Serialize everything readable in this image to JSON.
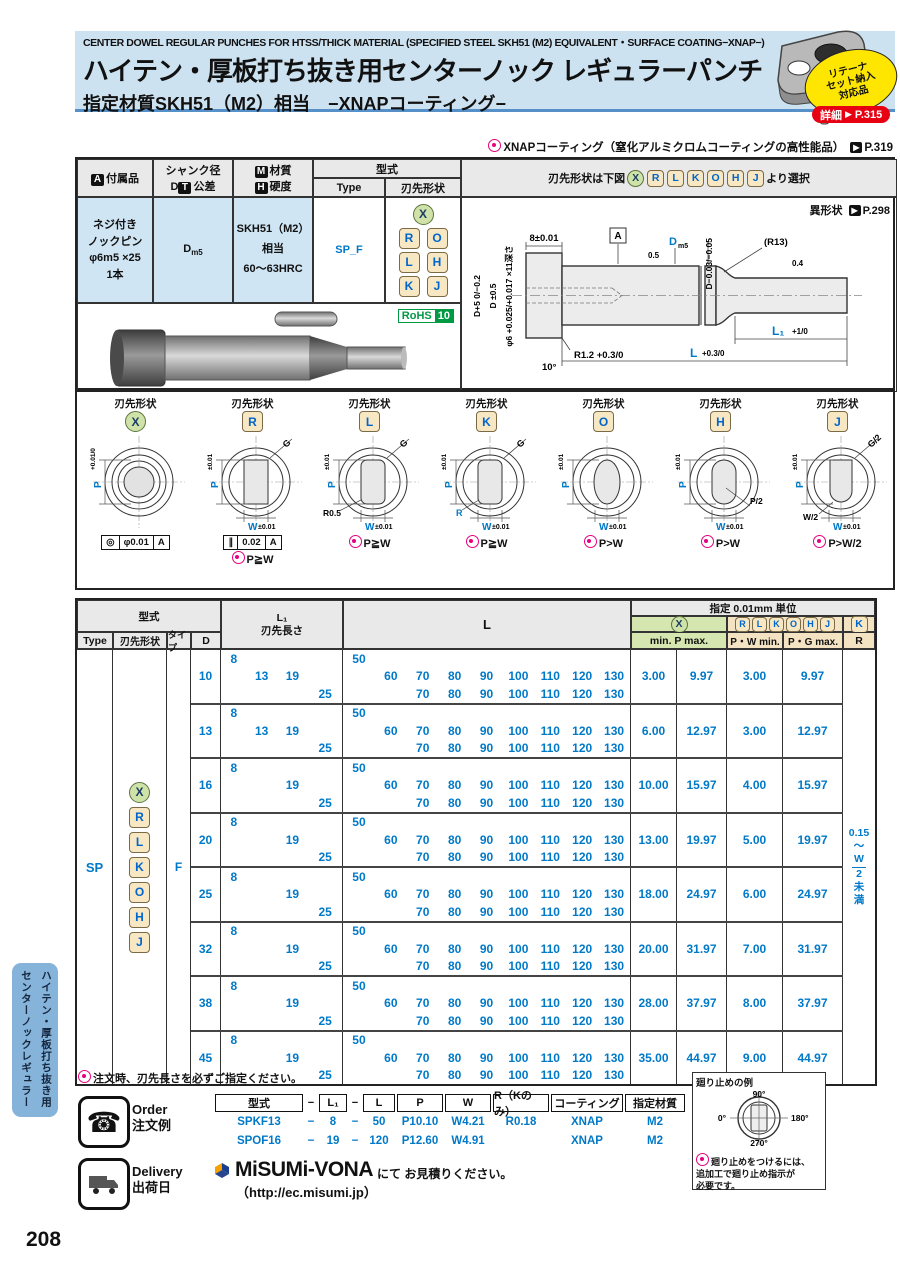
{
  "page": {
    "number": "208"
  },
  "sidebar": {
    "line1": "ハイテン・厚板打ち抜き用",
    "line2": "センターノックレギュラー"
  },
  "header": {
    "title_en": "CENTER DOWEL REGULAR PUNCHES FOR HTSS/THICK MATERIAL (SPECIFIED STEEL SKH51 (M2) EQUIVALENT・SURFACE COATING−XNAP−)",
    "title_jp": "ハイテン・厚板打ち抜き用センターノック レギュラーパンチ",
    "subtitle_jp": "指定材質SKH51（M2）相当　−XNAPコーティング−"
  },
  "retainer": {
    "badge_lines": [
      "リテーナ",
      "セット納入",
      "対応品"
    ],
    "detail_label": "詳細",
    "detail_page": "P.315"
  },
  "xnap_note": {
    "text": "XNAPコーティング（窒化アルミクロムコーティングの高性能品）",
    "page": "P.319"
  },
  "spec_table": {
    "accessory_badge": "A",
    "accessory_hdr": "付属品",
    "shank_hdr1": "シャンク径",
    "shank_d": "D",
    "shank_t": "T",
    "shank_hdr2": "公差",
    "material_m": "M",
    "material_hdr": "材質",
    "hardness_h": "H",
    "hardness_hdr": "硬度",
    "model_hdr": "型式",
    "type_hdr": "Type",
    "tip_hdr": "刃先形状",
    "select_pre": "刃先形状は下図",
    "select_letters": [
      "X",
      "R",
      "L",
      "K",
      "O",
      "H",
      "J"
    ],
    "select_post": "より選択",
    "accessory_lines": [
      "ネジ付き",
      "ノックピン",
      "φ6m5 ×25",
      "1本"
    ],
    "shank_value_main": "D",
    "shank_value_sub": "m5",
    "material_value1": "SKH51（M2）相当",
    "material_value2": "60〜63HRC",
    "type_value": "SP_F",
    "tip_rows": [
      [
        "R",
        "O"
      ],
      [
        "L",
        "H"
      ],
      [
        "K",
        "J"
      ]
    ],
    "rohs_label": "RoHS",
    "rohs_num": "10",
    "alt_shape_note": "異形状",
    "alt_shape_page": "P.298"
  },
  "drawing": {
    "dim8": "8±0.01",
    "datum": "A",
    "sf1": "0.5",
    "shank_d": "D",
    "shank_sub": "m5",
    "d_tol": "D−0.03/−0.05",
    "r13": "(R13)",
    "sf2": "0.4",
    "left1": "D+5 0/−0.2",
    "left2": "D ±0.5",
    "left3": "φ6 +0.025/+0.017 ×11深さ",
    "r12": "R1.2 +0.3/0",
    "angle": "10°",
    "l_main": "L",
    "l_tol": "+0.3/0",
    "l1_main": "L₁",
    "l1_tol": "+1/0"
  },
  "shapes": {
    "label": "刃先形状",
    "items": [
      {
        "letter": "X",
        "style": "green",
        "shape": "circle",
        "p": "P",
        "p_tol": "+0.01/0",
        "w": "",
        "w_tol": "",
        "g": "",
        "extra": "",
        "frame": [
          "◎",
          "φ0.01",
          "A"
        ],
        "note": ""
      },
      {
        "letter": "R",
        "style": "tan",
        "shape": "rect",
        "p": "P",
        "p_tol": "±0.01",
        "w": "W",
        "w_tol": "±0.01",
        "g": "G",
        "extra": "",
        "frame": [
          "∥",
          "0.02",
          "A"
        ],
        "note": "P≧W"
      },
      {
        "letter": "L",
        "style": "tan",
        "shape": "rrect",
        "p": "P",
        "p_tol": "±0.01",
        "w": "W",
        "w_tol": "±0.01",
        "g": "G",
        "extra": "R0.5",
        "frame": null,
        "note": "P≧W"
      },
      {
        "letter": "K",
        "style": "tan",
        "shape": "rrect",
        "p": "P",
        "p_tol": "±0.01",
        "w": "W",
        "w_tol": "±0.01",
        "g": "G",
        "extra": "R",
        "frame": null,
        "note": "P≧W"
      },
      {
        "letter": "O",
        "style": "tan",
        "shape": "oval",
        "p": "P",
        "p_tol": "±0.01",
        "w": "W",
        "w_tol": "±0.01",
        "g": "",
        "extra": "",
        "frame": null,
        "note": "P>W"
      },
      {
        "letter": "H",
        "style": "tan",
        "shape": "stadium",
        "p": "P",
        "p_tol": "±0.01",
        "w": "W",
        "w_tol": "±0.01",
        "g": "",
        "extra": "P/2",
        "frame": null,
        "note": "P>W"
      },
      {
        "letter": "J",
        "style": "tan",
        "shape": "dshape",
        "p": "P",
        "p_tol": "±0.01",
        "w": "W",
        "w_tol": "±0.01",
        "g": "G/2",
        "extra": "W/2",
        "frame": null,
        "note": "P>W/2"
      }
    ],
    "note1": "対角長Gが刃先寸法の最大値を超えないよう、",
    "note2": "P寸法とW寸法をチェックしてください。",
    "note3": "廻り止めをつけるには、追加工で廻り止め指示が必要です。",
    "f1_label": "K,L形状:",
    "f1_pre": "G=",
    "f1_sqrt": "(P-2R)²+ (W-2R)²",
    "f1_post": "+ 2R",
    "f2_label": "J,R形状:",
    "f2_pre": "G=",
    "f2_sqrt": "P²+W²",
    "f2_post": ""
  },
  "main_table": {
    "model_hdr": "型式",
    "type_hdr": "Type",
    "tip_hdr": "刃先形状",
    "taipu_hdr": "タイプ",
    "d_hdr": "D",
    "l1_hdr1": "L₁",
    "l1_hdr2": "刃先長さ",
    "l_hdr": "L",
    "spec_hdr": "指定 0.01mm 単位",
    "x_letter": "X",
    "rlkohj_letters": [
      "R",
      "L",
      "K",
      "O",
      "H",
      "J"
    ],
    "k_letter": "K",
    "minmax_hdr": "min. P max.",
    "pw_hdr": "P・W min.",
    "pg_hdr": "P・G max.",
    "r_hdr": "R",
    "type_value": "SP",
    "shape_letters": [
      "X",
      "R",
      "L",
      "K",
      "O",
      "H",
      "J"
    ],
    "taipu_value": "F",
    "r_note": {
      "top": "0.15",
      "tilde": "〜",
      "num": "W",
      "den": "2",
      "tail1": "未",
      "tail2": "満"
    },
    "blocks": [
      {
        "d": "10",
        "l1": [
          [
            "8",
            "",
            "",
            ""
          ],
          [
            "",
            "13",
            "19",
            ""
          ],
          [
            "",
            "",
            "",
            "25"
          ]
        ],
        "l": [
          [
            "50",
            "",
            "",
            "",
            "",
            "",
            "",
            "",
            ""
          ],
          [
            "",
            "60",
            "70",
            "80",
            "90",
            "100",
            "110",
            "120",
            "130"
          ],
          [
            "",
            "",
            "70",
            "80",
            "90",
            "100",
            "110",
            "120",
            "130"
          ]
        ],
        "vals": [
          "3.00",
          "9.97",
          "3.00",
          "9.97"
        ]
      },
      {
        "d": "13",
        "l1": [
          [
            "8",
            "",
            "",
            ""
          ],
          [
            "",
            "13",
            "19",
            ""
          ],
          [
            "",
            "",
            "",
            "25"
          ]
        ],
        "l": [
          [
            "50",
            "",
            "",
            "",
            "",
            "",
            "",
            "",
            ""
          ],
          [
            "",
            "60",
            "70",
            "80",
            "90",
            "100",
            "110",
            "120",
            "130"
          ],
          [
            "",
            "",
            "70",
            "80",
            "90",
            "100",
            "110",
            "120",
            "130"
          ]
        ],
        "vals": [
          "6.00",
          "12.97",
          "3.00",
          "12.97"
        ]
      },
      {
        "d": "16",
        "l1": [
          [
            "8",
            "",
            "",
            ""
          ],
          [
            "",
            "",
            "19",
            ""
          ],
          [
            "",
            "",
            "",
            "25"
          ]
        ],
        "l": [
          [
            "50",
            "",
            "",
            "",
            "",
            "",
            "",
            "",
            ""
          ],
          [
            "",
            "60",
            "70",
            "80",
            "90",
            "100",
            "110",
            "120",
            "130"
          ],
          [
            "",
            "",
            "70",
            "80",
            "90",
            "100",
            "110",
            "120",
            "130"
          ]
        ],
        "vals": [
          "10.00",
          "15.97",
          "4.00",
          "15.97"
        ]
      },
      {
        "d": "20",
        "l1": [
          [
            "8",
            "",
            "",
            ""
          ],
          [
            "",
            "",
            "19",
            ""
          ],
          [
            "",
            "",
            "",
            "25"
          ]
        ],
        "l": [
          [
            "50",
            "",
            "",
            "",
            "",
            "",
            "",
            "",
            ""
          ],
          [
            "",
            "60",
            "70",
            "80",
            "90",
            "100",
            "110",
            "120",
            "130"
          ],
          [
            "",
            "",
            "70",
            "80",
            "90",
            "100",
            "110",
            "120",
            "130"
          ]
        ],
        "vals": [
          "13.00",
          "19.97",
          "5.00",
          "19.97"
        ]
      },
      {
        "d": "25",
        "l1": [
          [
            "8",
            "",
            "",
            ""
          ],
          [
            "",
            "",
            "19",
            ""
          ],
          [
            "",
            "",
            "",
            "25"
          ]
        ],
        "l": [
          [
            "50",
            "",
            "",
            "",
            "",
            "",
            "",
            "",
            ""
          ],
          [
            "",
            "60",
            "70",
            "80",
            "90",
            "100",
            "110",
            "120",
            "130"
          ],
          [
            "",
            "",
            "70",
            "80",
            "90",
            "100",
            "110",
            "120",
            "130"
          ]
        ],
        "vals": [
          "18.00",
          "24.97",
          "6.00",
          "24.97"
        ]
      },
      {
        "d": "32",
        "l1": [
          [
            "8",
            "",
            "",
            ""
          ],
          [
            "",
            "",
            "19",
            ""
          ],
          [
            "",
            "",
            "",
            "25"
          ]
        ],
        "l": [
          [
            "50",
            "",
            "",
            "",
            "",
            "",
            "",
            "",
            ""
          ],
          [
            "",
            "60",
            "70",
            "80",
            "90",
            "100",
            "110",
            "120",
            "130"
          ],
          [
            "",
            "",
            "70",
            "80",
            "90",
            "100",
            "110",
            "120",
            "130"
          ]
        ],
        "vals": [
          "20.00",
          "31.97",
          "7.00",
          "31.97"
        ]
      },
      {
        "d": "38",
        "l1": [
          [
            "8",
            "",
            "",
            ""
          ],
          [
            "",
            "",
            "19",
            ""
          ],
          [
            "",
            "",
            "",
            "25"
          ]
        ],
        "l": [
          [
            "50",
            "",
            "",
            "",
            "",
            "",
            "",
            "",
            ""
          ],
          [
            "",
            "60",
            "70",
            "80",
            "90",
            "100",
            "110",
            "120",
            "130"
          ],
          [
            "",
            "",
            "70",
            "80",
            "90",
            "100",
            "110",
            "120",
            "130"
          ]
        ],
        "vals": [
          "28.00",
          "37.97",
          "8.00",
          "37.97"
        ]
      },
      {
        "d": "45",
        "l1": [
          [
            "8",
            "",
            "",
            ""
          ],
          [
            "",
            "",
            "19",
            ""
          ],
          [
            "",
            "",
            "",
            "25"
          ]
        ],
        "l": [
          [
            "50",
            "",
            "",
            "",
            "",
            "",
            "",
            "",
            ""
          ],
          [
            "",
            "60",
            "70",
            "80",
            "90",
            "100",
            "110",
            "120",
            "130"
          ],
          [
            "",
            "",
            "70",
            "80",
            "90",
            "100",
            "110",
            "120",
            "130"
          ]
        ],
        "vals": [
          "35.00",
          "44.97",
          "9.00",
          "44.97"
        ]
      }
    ]
  },
  "footnote": "注文時、刃先長さを必ずご指定ください。",
  "order": {
    "label_en": "Order",
    "label_jp": "注文例",
    "headers": [
      "型式",
      "−",
      "L₁",
      "−",
      "L",
      "P",
      "W",
      "R（Kのみ）",
      "コーティング",
      "指定材質"
    ],
    "rows": [
      [
        "SPKF13",
        "−",
        "8",
        "−",
        "50",
        "P10.10",
        "W4.21",
        "R0.18",
        "XNAP",
        "M2"
      ],
      [
        "SPOF16",
        "−",
        "19",
        "−",
        "120",
        "P12.60",
        "W4.91",
        "",
        "XNAP",
        "M2"
      ]
    ]
  },
  "delivery": {
    "label_en": "Delivery",
    "label_jp": "出荷日",
    "logo": "MiSUMi-VONA",
    "text": "にて お見積りください。",
    "url": "（http://ec.misumi.jp）"
  },
  "rotation": {
    "title": "廻り止めの例",
    "angle_top": "90°",
    "angle_left": "0°",
    "angle_right": "180°",
    "angle_bottom": "270°",
    "note_lines": [
      "廻り止めをつけるには、",
      "追加工で廻り止め指示が",
      "必要です。"
    ]
  }
}
